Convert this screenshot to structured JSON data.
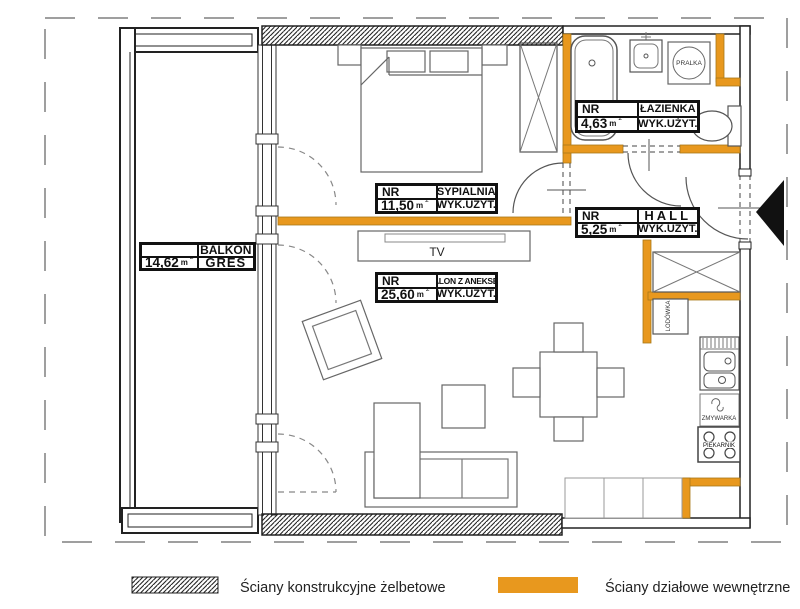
{
  "colors": {
    "partition_wall": "#E8981E"
  },
  "units": {
    "area_unit": "m",
    "area_sup": "2"
  },
  "rooms": {
    "balkon": {
      "area": "14,62",
      "name": "BALKON",
      "floor": "GRES"
    },
    "sypialnia": {
      "nr": "NR",
      "area": "11,50",
      "name": "SYPIALNIA",
      "usage": "WYK.UŻYT."
    },
    "lazienka": {
      "nr": "NR",
      "area": "4,63",
      "name": "ŁAZIENKA",
      "usage": "WYK.UŻYT."
    },
    "hall": {
      "nr": "NR",
      "area": "5,25",
      "name": "HALL",
      "usage": "WYK.UŻYT."
    },
    "salon": {
      "nr": "NR",
      "area": "25,60",
      "name": "SALON Z ANEKSEM",
      "usage": "WYK.UŻYT."
    }
  },
  "appliances": {
    "washer": "PRALKA",
    "fridge": "LODÓWKA",
    "dishwasher": "ZMYWARKA",
    "oven": "PIEKARNIK",
    "tv": "TV"
  },
  "legend": {
    "structural": "Ściany konstrukcyjne żelbetowe",
    "partition": "Ściany działowe wewnętrzne"
  }
}
